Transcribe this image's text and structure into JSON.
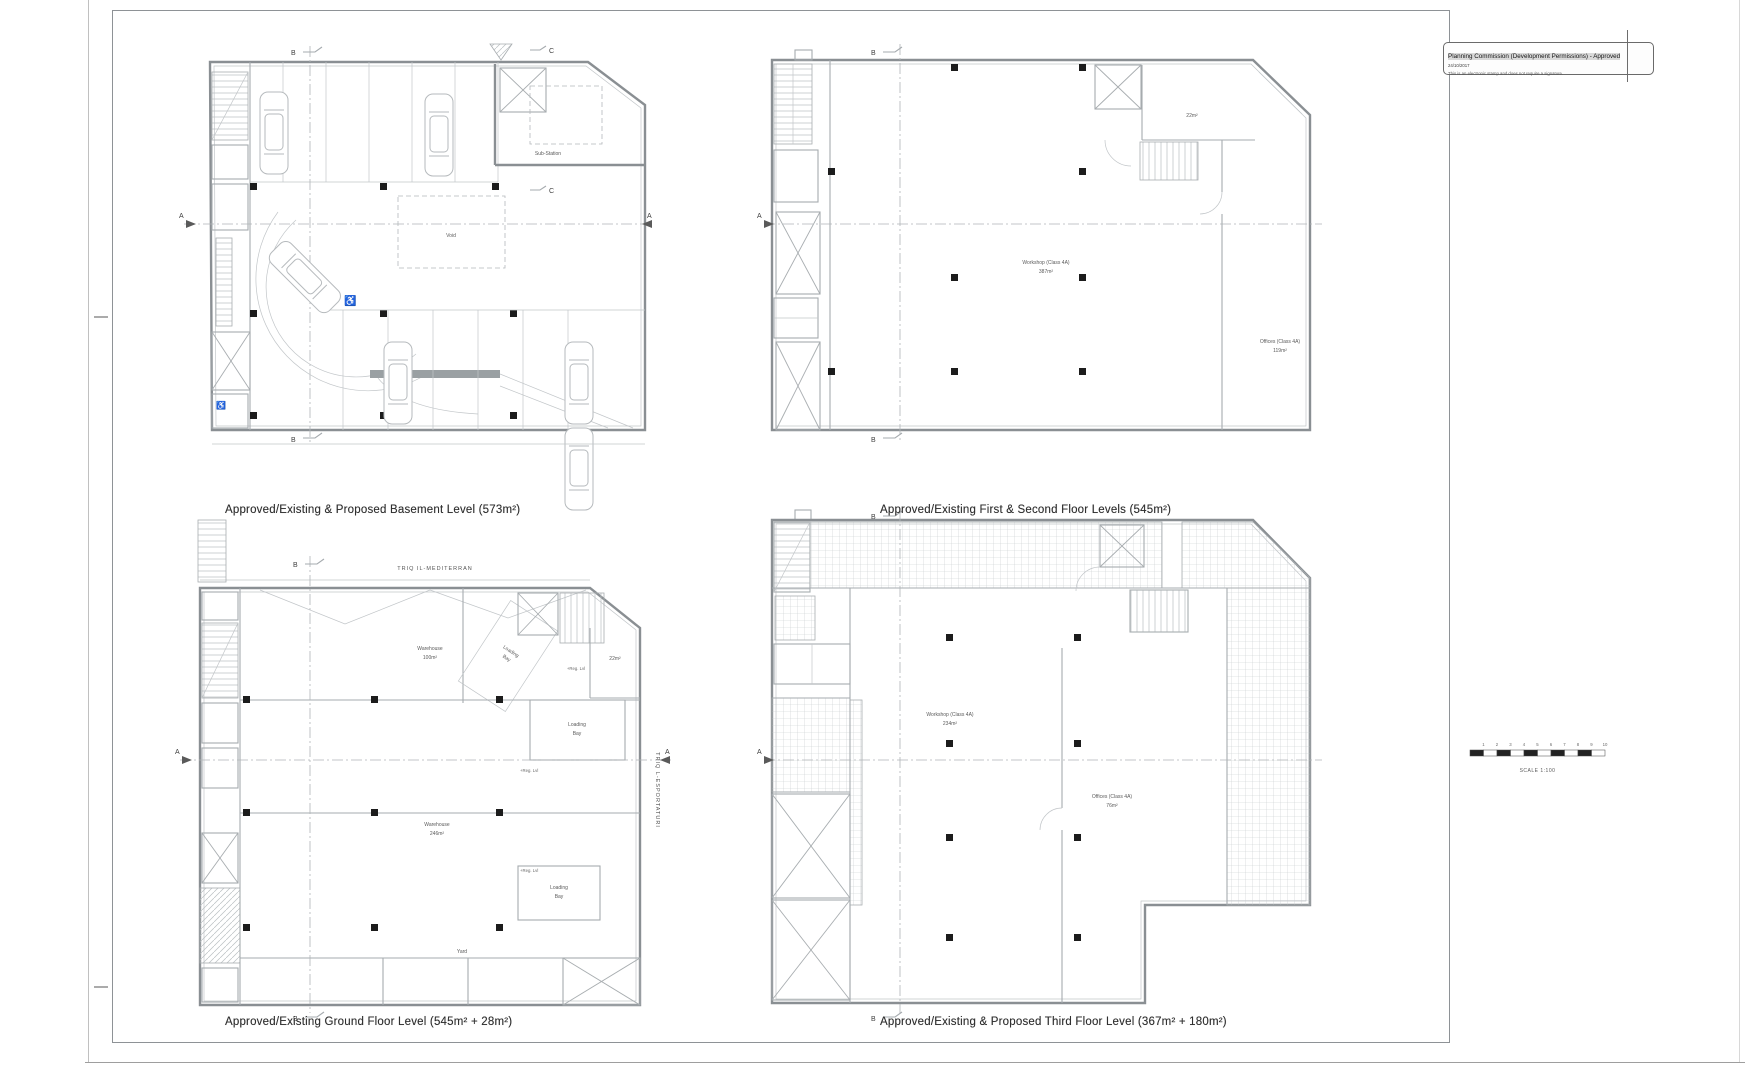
{
  "sheet": {
    "stamp": {
      "title": "Planning Commission (Development Permissions) - Approved",
      "date": "24/10/2017",
      "note": "This is an electronic stamp and does not require a signature."
    },
    "scale_bar": {
      "label": "SCALE 1:100",
      "ticks": [
        "1",
        "2",
        "3",
        "4",
        "5",
        "6",
        "7",
        "8",
        "9",
        "10"
      ]
    },
    "sections": {
      "a": "A",
      "b": "B",
      "c": "C"
    },
    "icons": {
      "wheelchair": "♿"
    },
    "plans": {
      "basement": {
        "caption": "Approved/Existing & Proposed Basement Level (573m²)",
        "labels": {
          "substation": "Sub-Station",
          "void": "Void"
        }
      },
      "first_second": {
        "caption": "Approved/Existing First & Second Floor Levels (545m²)",
        "labels": {
          "workshop": "Workshop (Class 4A)",
          "workshop_area": "387m²",
          "offices": "Offices (Class 4A)",
          "offices_area": "119m²",
          "room_area": "22m²"
        }
      },
      "ground": {
        "caption": "Approved/Existing Ground Floor Level (545m² + 28m²)",
        "street_top": "TRIQ IL-MEDITERRAN",
        "street_right": "TRIQ L-ESPORTATURI",
        "labels": {
          "warehouse_front": "Warehouse",
          "warehouse_front_area": "100m²",
          "warehouse_rear": "Warehouse",
          "warehouse_rear_area": "246m²",
          "loading_line1": "Loading",
          "loading_line2": "Bay",
          "room_area": "22m²",
          "yard": "Yard",
          "level_mark": "+Reg. Lvl"
        }
      },
      "third": {
        "caption": "Approved/Existing & Proposed Third Floor Level (367m² + 180m²)",
        "labels": {
          "workshop": "Workshop (Class 4A)",
          "workshop_area": "234m²",
          "offices": "Offices (Class 4A)",
          "offices_area": "76m²"
        }
      }
    }
  }
}
